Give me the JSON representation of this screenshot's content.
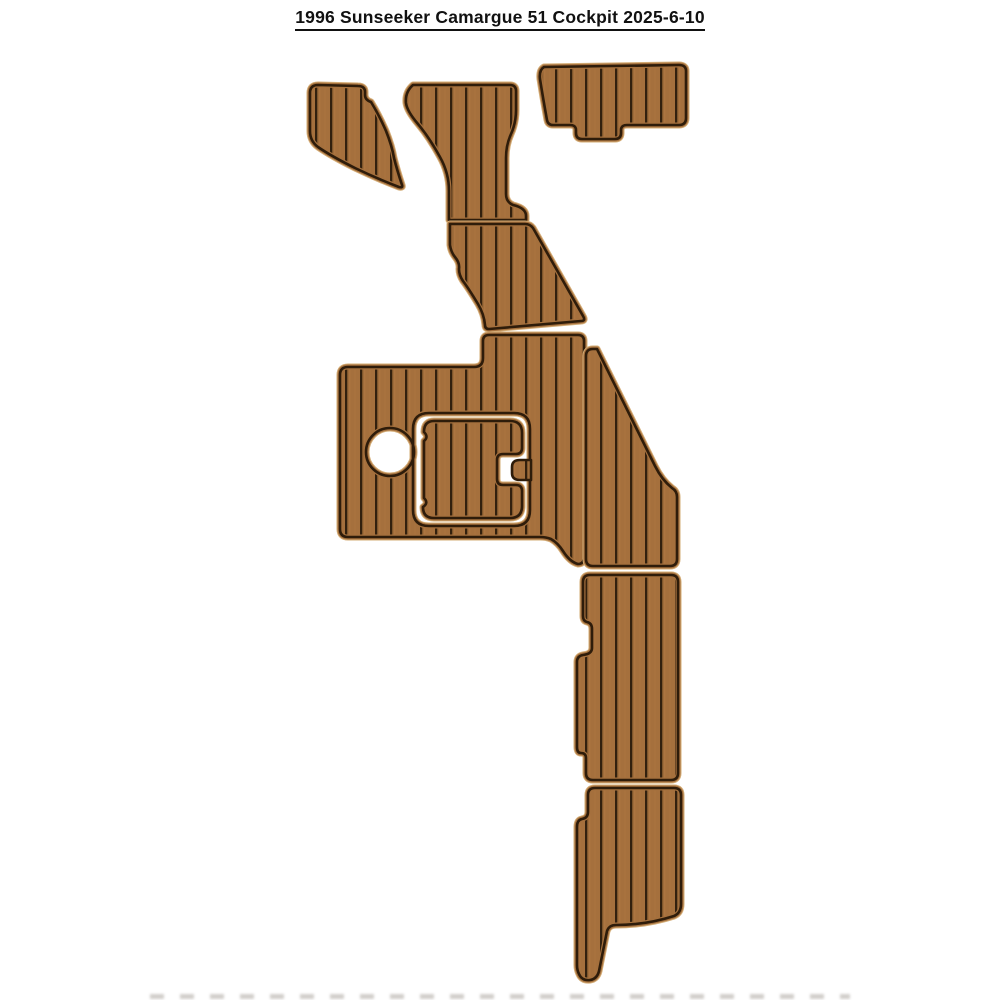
{
  "title": {
    "text": "1996 Sunseeker Camargue 51 Cockpit 2025-6-10"
  },
  "image": {
    "type": "product-photo",
    "subject": "EVA foam faux-teak cockpit decking pad set on white background",
    "plank_direction": "vertical",
    "piece_count": 10
  },
  "colors": {
    "bg": "#ffffff",
    "field": "#a5703d",
    "plank_line": "#32200e",
    "grain_light": "#b67d47",
    "border_dark": "#2e1c0a",
    "halo": "#d3ac76",
    "title_color": "#111111",
    "smudge": "#8a8178"
  }
}
